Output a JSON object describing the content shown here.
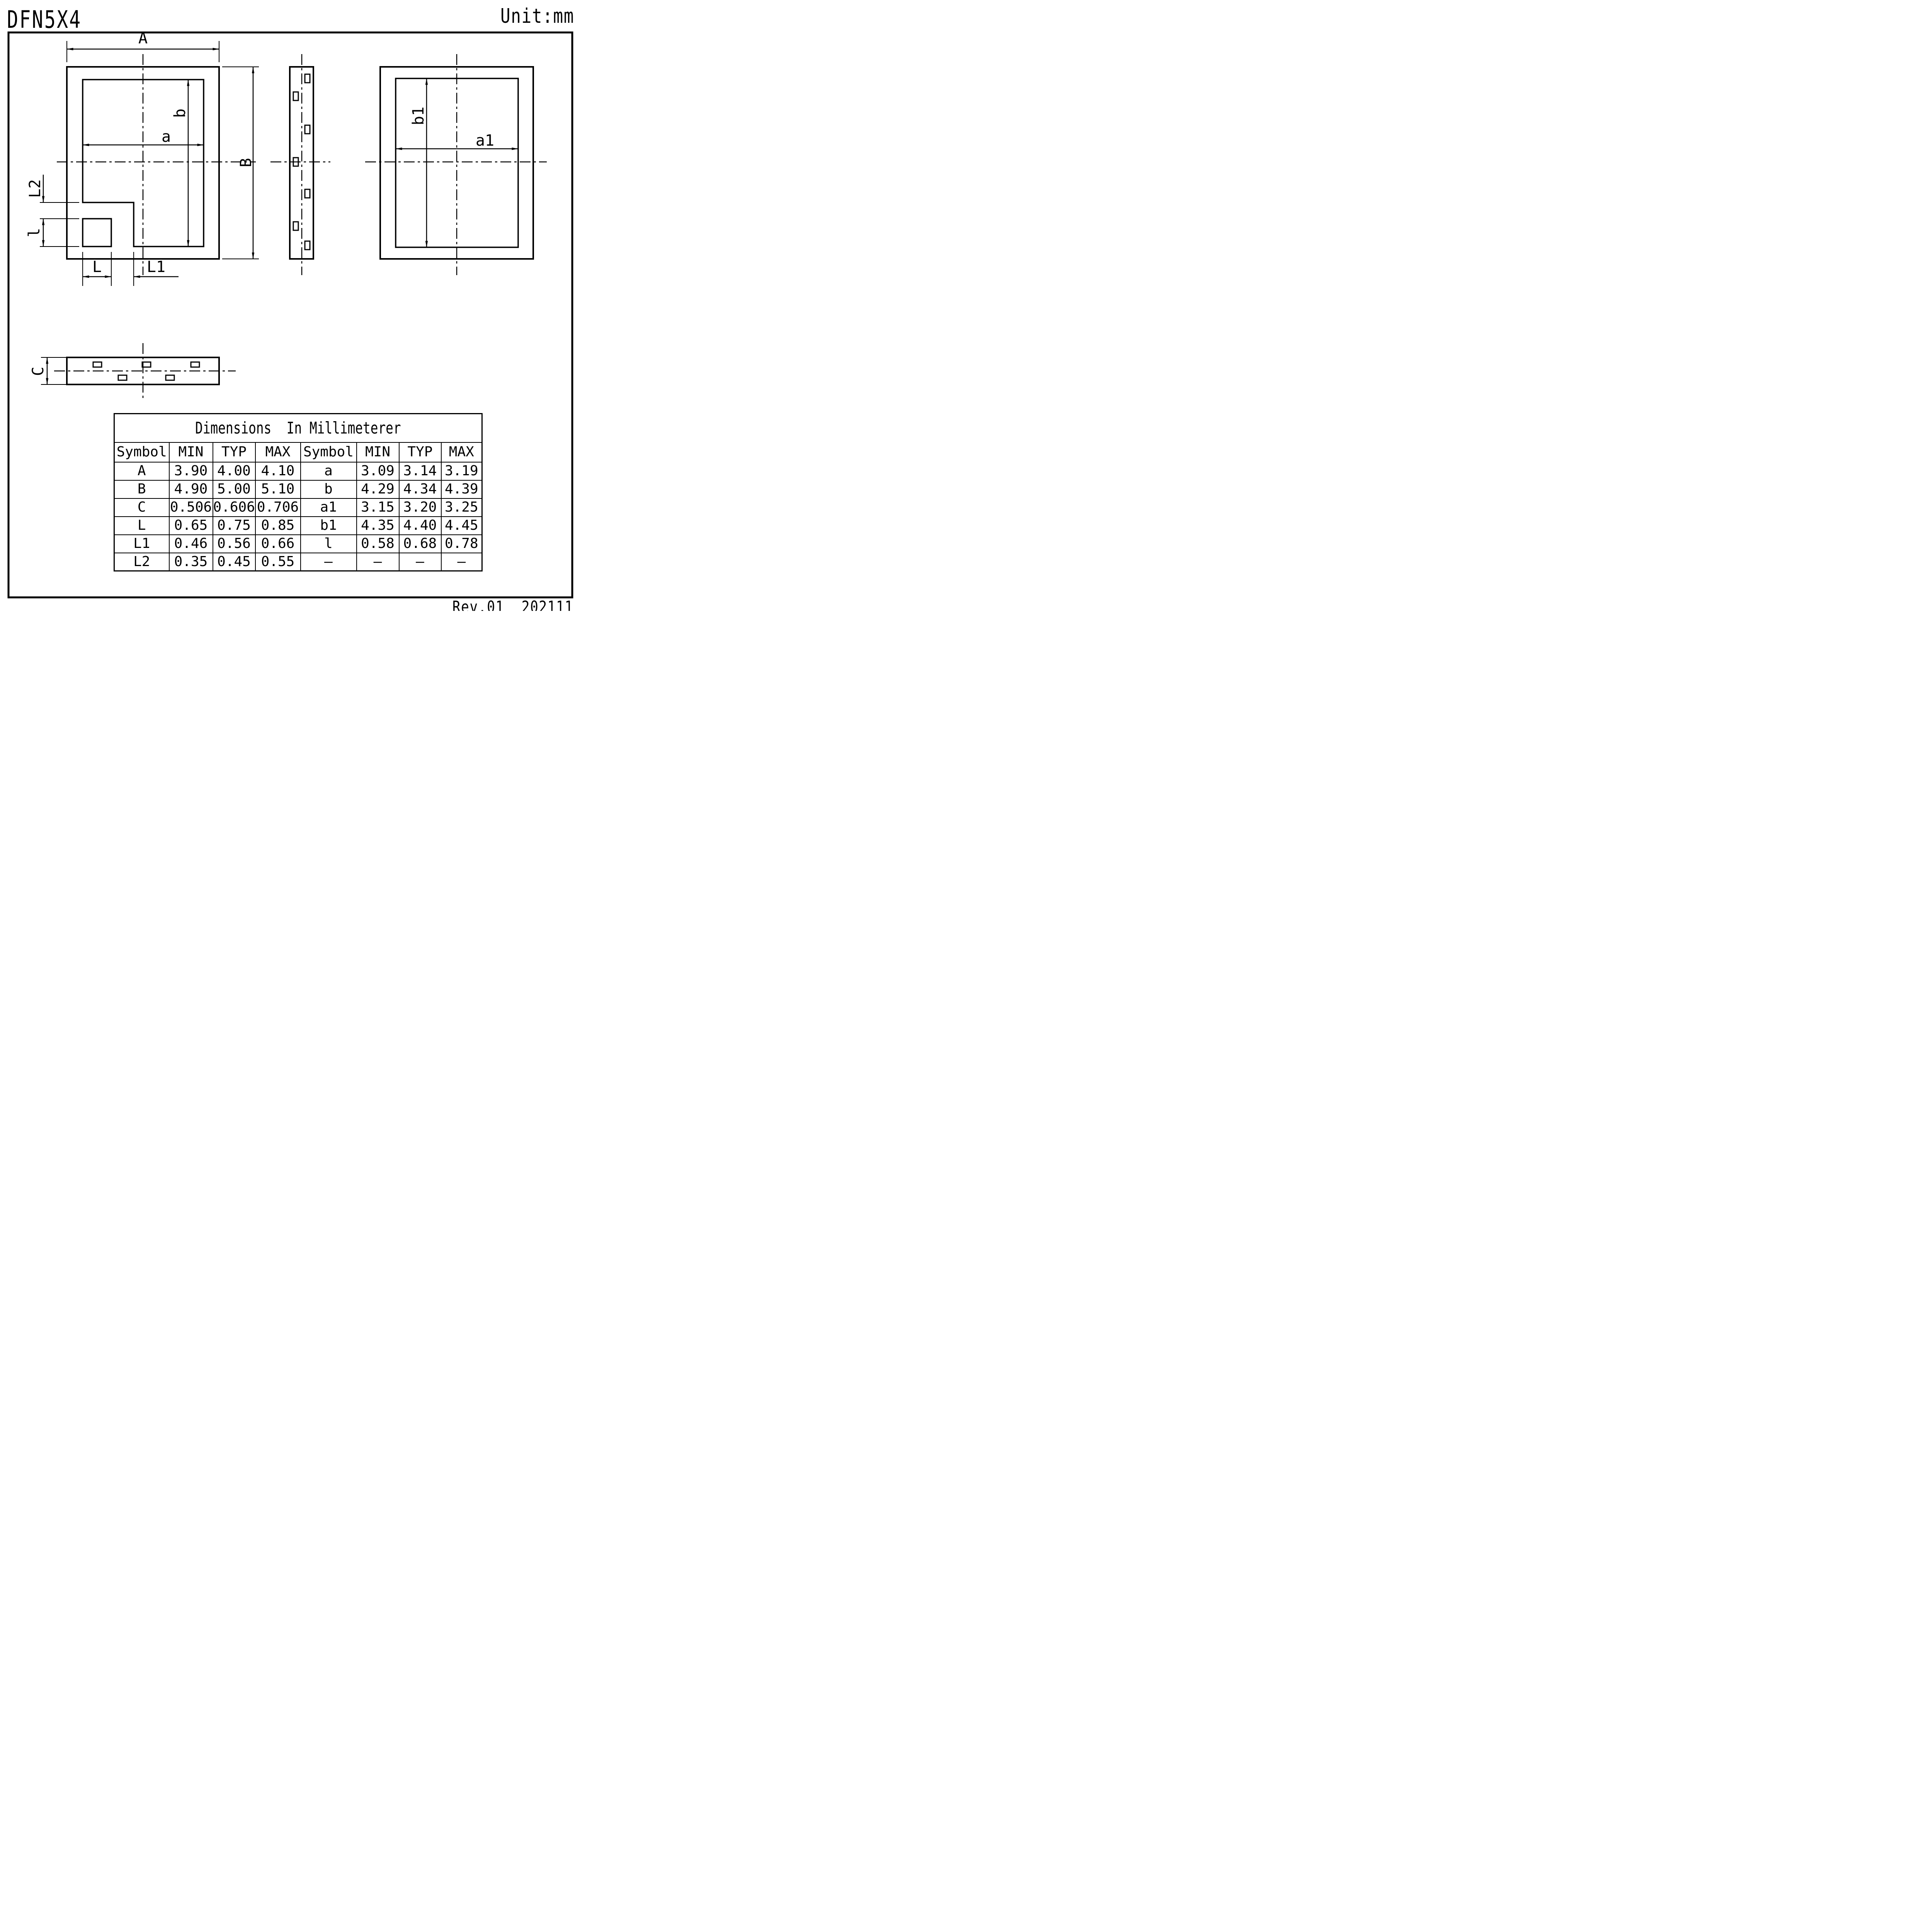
{
  "page": {
    "title": "DFN5X4",
    "unit": "Unit:mm",
    "revision": "Rev.01  202111"
  },
  "colors": {
    "ink": "#000000",
    "paper": "#ffffff"
  },
  "drawing": {
    "labels": {
      "A": "A",
      "B": "B",
      "a": "a",
      "b": "b",
      "a1": "a1",
      "b1": "b1",
      "L": "L",
      "L1": "L1",
      "L2": "L2",
      "l": "l",
      "C": "C"
    }
  },
  "table": {
    "title": "Dimensions  In Millimeterer",
    "headers": [
      "Symbol",
      "MIN",
      "TYP",
      "MAX",
      "Symbol",
      "MIN",
      "TYP",
      "MAX"
    ],
    "rows": [
      [
        "A",
        "3.90",
        "4.00",
        "4.10",
        "a",
        "3.09",
        "3.14",
        "3.19"
      ],
      [
        "B",
        "4.90",
        "5.00",
        "5.10",
        "b",
        "4.29",
        "4.34",
        "4.39"
      ],
      [
        "C",
        "0.506",
        "0.606",
        "0.706",
        "a1",
        "3.15",
        "3.20",
        "3.25"
      ],
      [
        "L",
        "0.65",
        "0.75",
        "0.85",
        "b1",
        "4.35",
        "4.40",
        "4.45"
      ],
      [
        "L1",
        "0.46",
        "0.56",
        "0.66",
        "l",
        "0.58",
        "0.68",
        "0.78"
      ],
      [
        "L2",
        "0.35",
        "0.45",
        "0.55",
        "–",
        "–",
        "–",
        "–"
      ]
    ]
  }
}
